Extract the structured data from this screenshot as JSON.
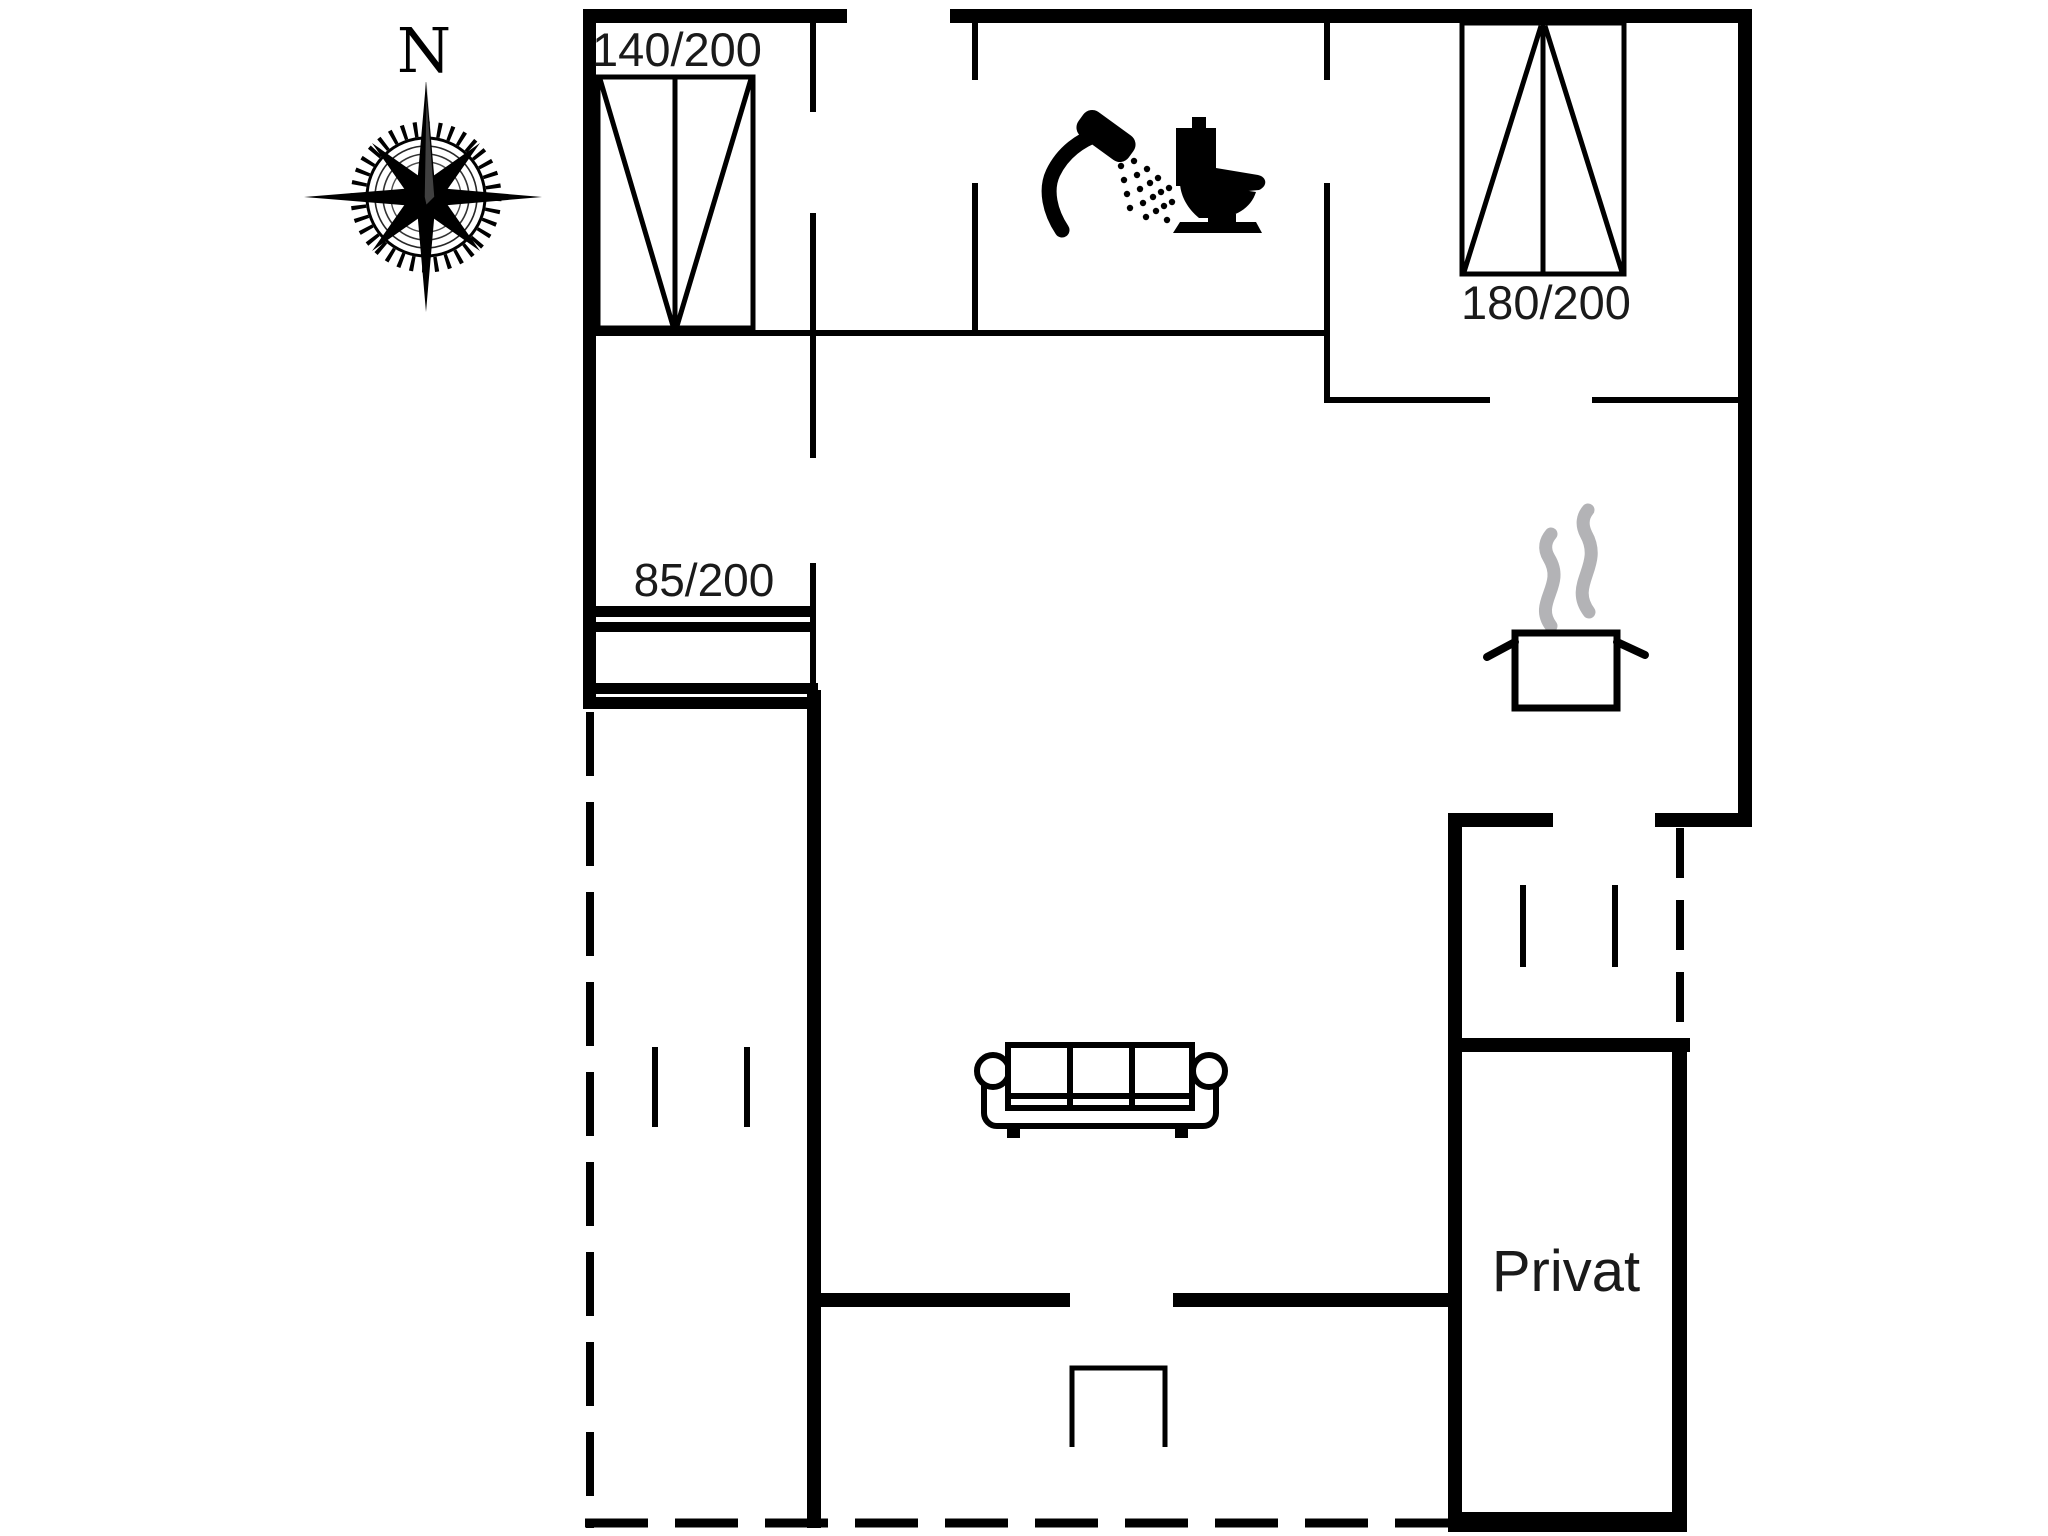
{
  "floor_plan": {
    "compass": {
      "north_label": "N"
    },
    "labels": {
      "bed_small": "140/200",
      "bed_large": "180/200",
      "entry_door": "85/200",
      "private_room": "Privat"
    },
    "icons": {
      "compass": "compass-rose-icon",
      "bed_small": "double-bed-icon",
      "bed_large": "double-bed-icon",
      "shower": "shower-icon",
      "toilet": "toilet-icon",
      "stove": "cooking-pot-icon",
      "sofa": "sofa-icon",
      "step": "terrace-step-icon"
    },
    "colors": {
      "walls": "#000000",
      "steam_gray": "#b3b3b6",
      "background": "#ffffff"
    }
  }
}
